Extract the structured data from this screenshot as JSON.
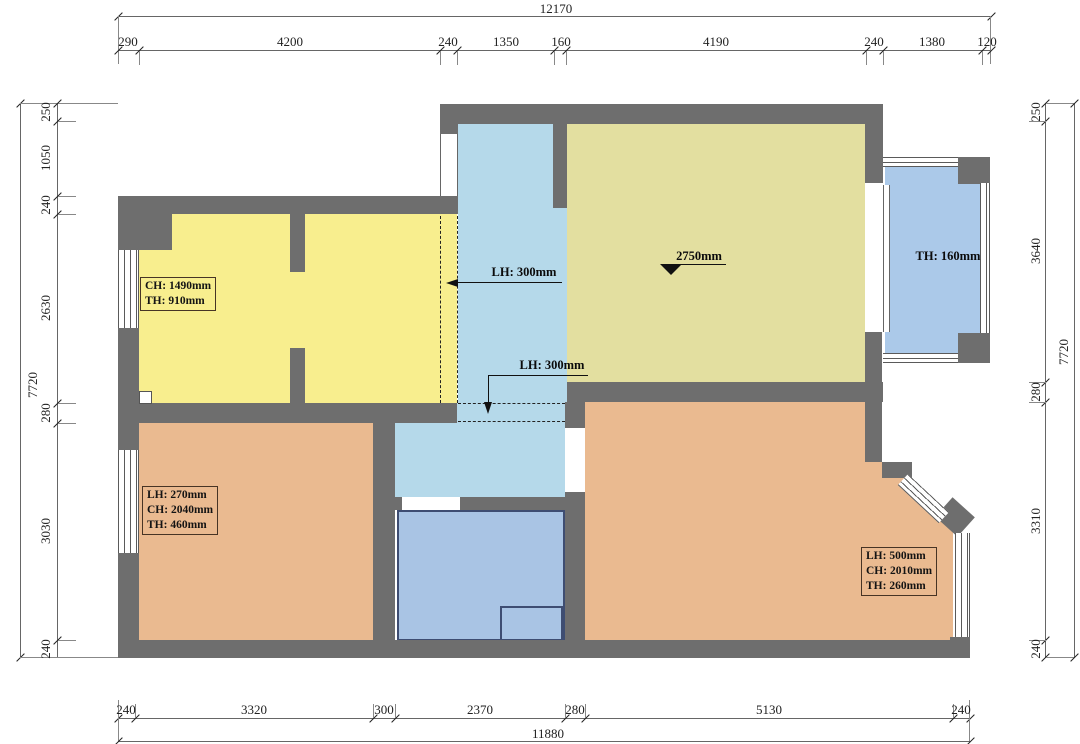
{
  "annotations": {
    "room_top_left": [
      "CH: 1490mm",
      "TH: 910mm"
    ],
    "room_bottom_left": [
      "LH: 270mm",
      "CH: 2040mm",
      "TH: 460mm"
    ],
    "room_bottom_right": [
      "LH: 500mm",
      "CH: 2010mm",
      "TH: 260mm"
    ],
    "balcony": "TH: 160mm",
    "hall_upper": "LH: 300mm",
    "hall_lower": "LH: 300mm",
    "living_level": "2750mm"
  },
  "dimensions": {
    "top": {
      "total": "12170",
      "segments": [
        "290",
        "4200",
        "240",
        "1350",
        "160",
        "4190",
        "240",
        "1380",
        "120"
      ]
    },
    "bottom": {
      "total": "11880",
      "segments": [
        "240",
        "3320",
        "300",
        "2370",
        "280",
        "5130",
        "240"
      ]
    },
    "left": {
      "total": "7720",
      "segments": [
        "250",
        "1050",
        "240",
        "2630",
        "280",
        "3030",
        "240"
      ]
    },
    "right": {
      "total": "7720",
      "segments": [
        "250",
        "3640",
        "280",
        "3310",
        "240"
      ]
    }
  },
  "colors": {
    "wall": "#6e6e6e",
    "room_yellow": "#f8ee8e",
    "room_khaki": "#e3dfa0",
    "hall_blue": "#b5d9ea",
    "balcony_blue": "#abc9e9",
    "bath_blue": "#a9c4e4",
    "room_orange": "#eaba90"
  }
}
